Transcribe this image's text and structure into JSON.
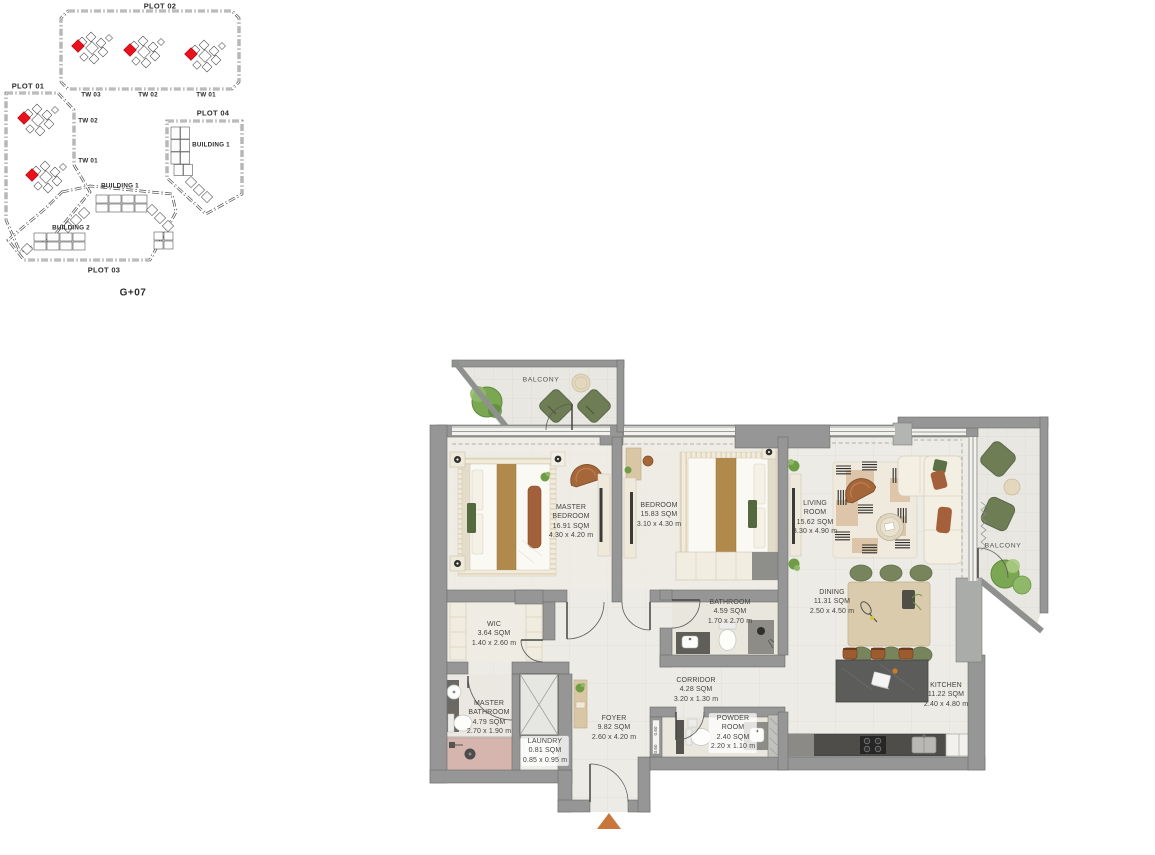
{
  "site_plan": {
    "level_label": "G+07",
    "unit_highlight_color": "#e8111c",
    "plots": [
      {
        "name": "PLOT 02",
        "towers": [
          {
            "label": "TW 03"
          },
          {
            "label": "TW 02"
          },
          {
            "label": "TW 01"
          }
        ]
      },
      {
        "name": "PLOT 01",
        "towers": [
          {
            "label": "TW 02"
          },
          {
            "label": "TW 01"
          }
        ]
      },
      {
        "name": "PLOT 03",
        "buildings": [
          {
            "label": "BUILDING 1"
          },
          {
            "label": "BUILDING 2"
          }
        ]
      },
      {
        "name": "PLOT 04",
        "buildings": [
          {
            "label": "BUILDING 1"
          }
        ]
      }
    ]
  },
  "floor_plan": {
    "entry_marker_color": "#c8763c",
    "duct_dimension": "0.60",
    "rooms": [
      {
        "id": "balcony-top-left",
        "name": "BALCONY",
        "area": "",
        "dimensions": ""
      },
      {
        "id": "master-bedroom",
        "name": "MASTER BEDROOM",
        "area": "16.91 SQM",
        "dimensions": "4.30 x 4.20 m"
      },
      {
        "id": "bedroom",
        "name": "BEDROOM",
        "area": "15.83 SQM",
        "dimensions": "3.10 x 4.30 m"
      },
      {
        "id": "living-room",
        "name": "LIVING ROOM",
        "area": "15.62 SQM",
        "dimensions": "3.30 x 4.90 m"
      },
      {
        "id": "balcony-right",
        "name": "BALCONY",
        "area": "",
        "dimensions": ""
      },
      {
        "id": "dining",
        "name": "DINING",
        "area": "11.31 SQM",
        "dimensions": "2.50 x 4.50 m"
      },
      {
        "id": "kitchen",
        "name": "KITCHEN",
        "area": "11.22 SQM",
        "dimensions": "2.40 x 4.80 m"
      },
      {
        "id": "bathroom",
        "name": "BATHROOM",
        "area": "4.59 SQM",
        "dimensions": "1.70 x 2.70 m"
      },
      {
        "id": "wic",
        "name": "WIC",
        "area": "3.64 SQM",
        "dimensions": "1.40 x 2.60 m"
      },
      {
        "id": "master-bathroom",
        "name": "MASTER BATHROOM",
        "area": "4.79 SQM",
        "dimensions": "2.70 x 1.90 m"
      },
      {
        "id": "laundry",
        "name": "LAUNDRY",
        "area": "0.81 SQM",
        "dimensions": "0.85 x 0.95 m"
      },
      {
        "id": "foyer",
        "name": "FOYER",
        "area": "9.82 SQM",
        "dimensions": "2.60 x 4.20 m"
      },
      {
        "id": "corridor",
        "name": "CORRIDOR",
        "area": "4.28 SQM",
        "dimensions": "3.20 x 1.30 m"
      },
      {
        "id": "powder-room",
        "name": "POWDER ROOM",
        "area": "2.40 SQM",
        "dimensions": "2.20 x 1.10 m"
      }
    ]
  }
}
